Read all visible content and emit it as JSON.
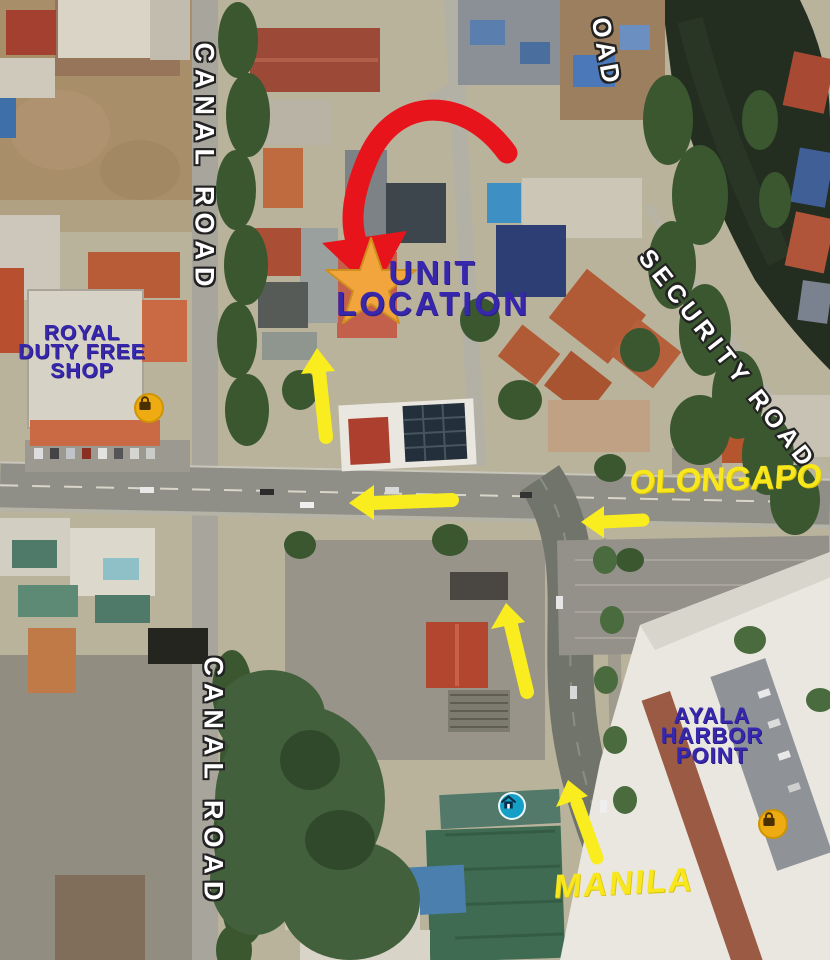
{
  "labels": {
    "unit_location_line1": "UNIT",
    "unit_location_line2": "LOCATION",
    "royal_line1": "ROYAL",
    "royal_line2": "DUTY FREE",
    "royal_line3": "SHOP",
    "ayala_line1": "AYALA",
    "ayala_line2": "HARBOR",
    "ayala_line3": "POINT",
    "canal_road_top": "CANAL ROAD",
    "canal_road_bottom": "CANAL ROAD",
    "security_road": "SECURITY ROAD",
    "road_partial_top": "OAD",
    "olongapo": "OLONGAPO",
    "manila": "MANILA"
  },
  "colors": {
    "label_navy": "#3627ac",
    "label_yellow": "#f8e71c",
    "road_label_white": "#ffffff",
    "arrow_red": "#e8141c",
    "arrow_yellow": "#f9ed1f",
    "star_orange": "#f2a53c",
    "star_edge": "#cf8f1f",
    "poi_shopping_bg": "#efac12",
    "poi_home_bg": "#14a0c6"
  },
  "icons": {
    "unit_star": "star-marker",
    "red_arrow": "curved-arrow-to-unit",
    "shopping_icon": "shopping-bag",
    "home_icon": "home"
  }
}
